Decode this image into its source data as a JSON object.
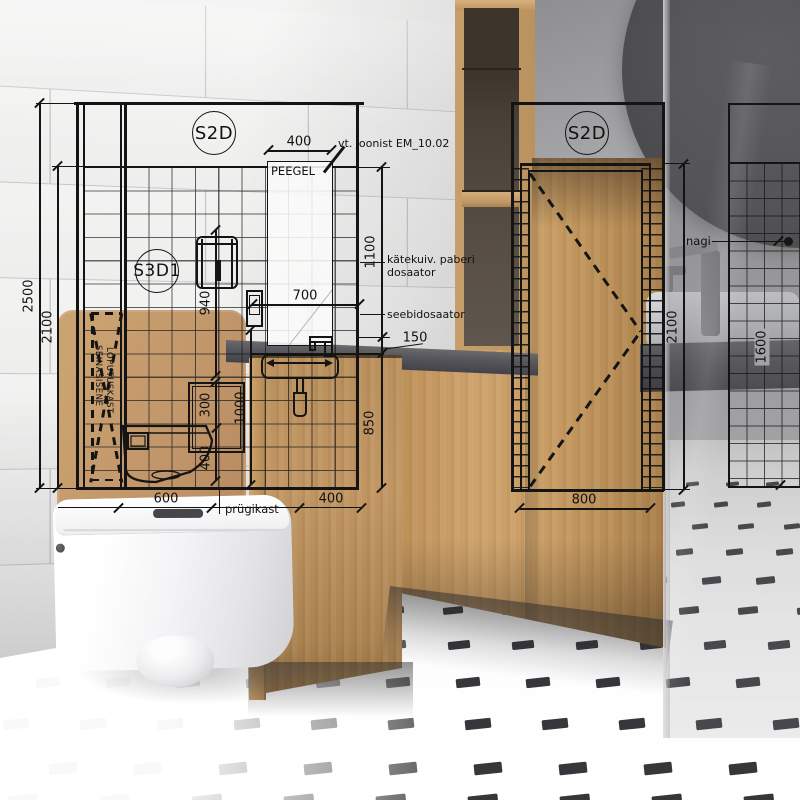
{
  "drawings": {
    "left": {
      "tag": "S2D",
      "detail_tag": "S3D1",
      "mirror_label": "PEEGEL",
      "reference_note": "vt. joonist EM_10.02",
      "towel_dispenser_label": {
        "line1": "kätekuiv. paberi",
        "line2": "dosaator"
      },
      "soap_dispenser_label": "seebidosaator",
      "waste_bin_label": "prügikast",
      "cistern_label": {
        "line1": "SEINASISENE",
        "line2": "LOPUTUSKAST"
      },
      "dims": {
        "wall_height": "2500",
        "tile_height": "2100",
        "mirror_width": "400",
        "upper_height": "1100",
        "counter_gap": "150",
        "lower_height": "850",
        "sink_width": "700",
        "holder_height": "940",
        "shelf_height": "300",
        "toilet_height": "400",
        "counter_height": "1000",
        "toilet_width": "600",
        "sink_offset": "400"
      }
    },
    "right": {
      "tag": "S2D",
      "dims": {
        "door_width": "800",
        "door_height": "2100"
      }
    },
    "far_right": {
      "hook_label": "nagi",
      "dims": {
        "tile_band_height": "1600"
      }
    }
  },
  "colors": {
    "wood": "#c59d6a",
    "drawing_line": "#141414",
    "floor_dash": "#26262a",
    "mirror": "#4a4a4d"
  }
}
